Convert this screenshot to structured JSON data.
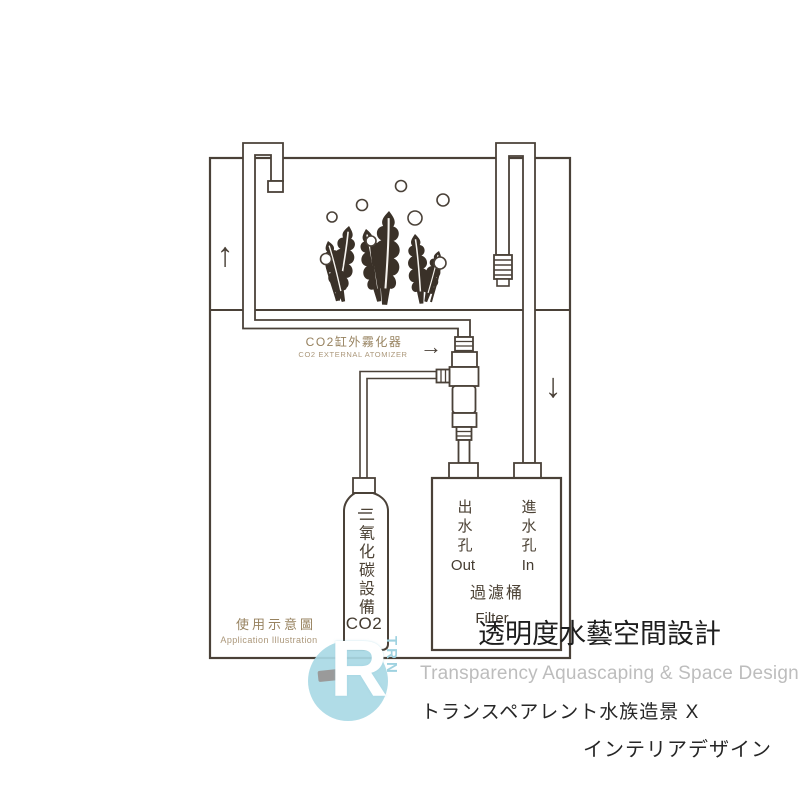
{
  "colors": {
    "ink": "#4a4138",
    "label_tan": "#97825f",
    "label_tan_light": "#ab977a",
    "watermark_dark": "#1e1e1e",
    "watermark_gray": "#bdbdbd",
    "logo_blue": "#a9d9e5",
    "plant_fill": "#3a3128",
    "paper": "#ffffff"
  },
  "diagram": {
    "arrows": {
      "up": "↑",
      "down": "↓",
      "pointer": "→"
    },
    "atomizer": {
      "label_zh": "CO2缸外霧化器",
      "label_en": "CO2 EXTERNAL ATOMIZER"
    },
    "cylinder": {
      "label_vertical": "二氧化碳設備",
      "label_en": "CO2"
    },
    "filter": {
      "outlet_zh": "出水孔",
      "outlet_en": "Out",
      "inlet_zh": "進水孔",
      "inlet_en": "In",
      "name_zh": "過濾桶",
      "name_en": "Filter"
    },
    "caption": {
      "zh": "使用示意圖",
      "en": "Application Illustration"
    }
  },
  "watermark": {
    "brand_zh": "透明度水藝空間設計",
    "brand_en": "Transparency Aquascaping & Space Design",
    "brand_jp_line1": "トランスペアレント水族造景 X",
    "brand_jp_line2": "インテリアデザイン",
    "logo_letter": "R",
    "logo_side_text": "TRN"
  }
}
